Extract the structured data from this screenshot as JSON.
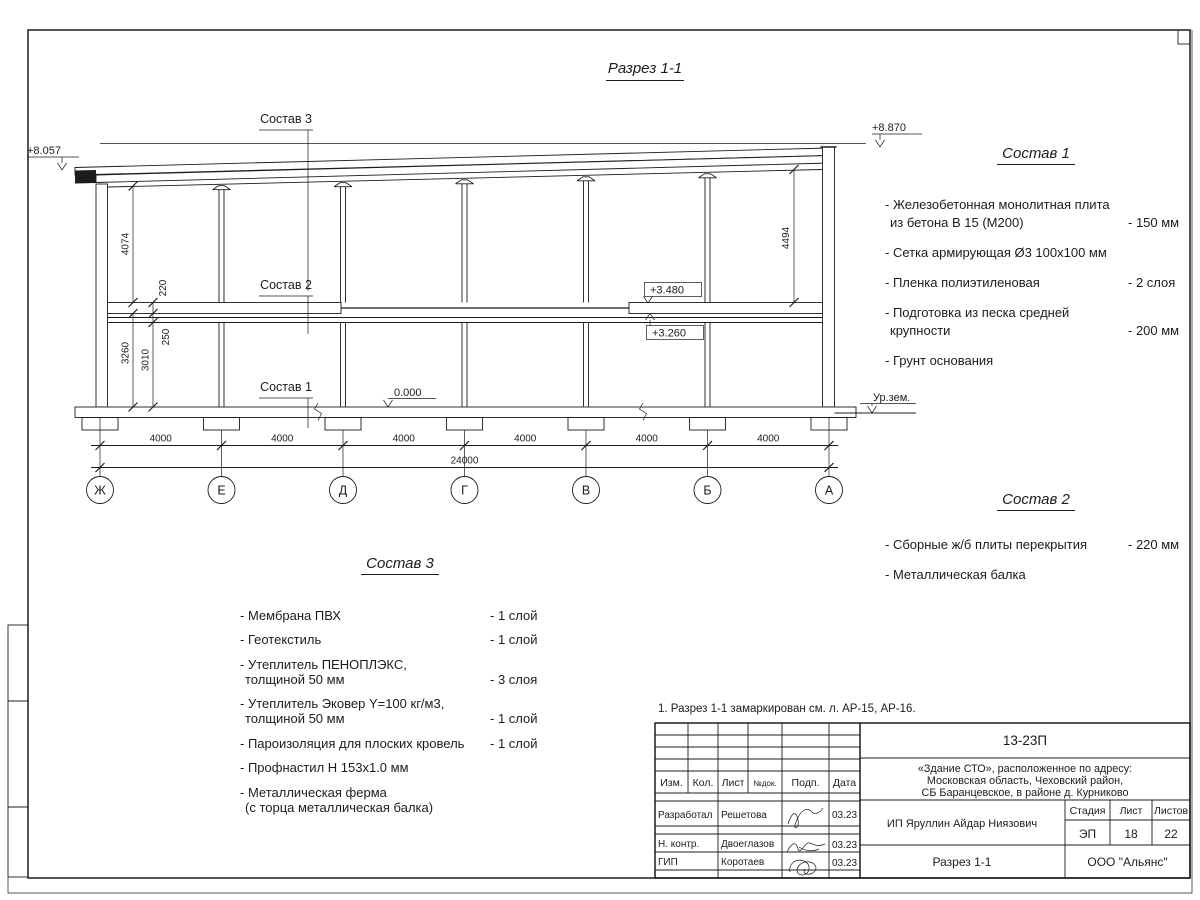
{
  "page": {
    "title": "Разрез 1-1"
  },
  "drawing": {
    "elev_left": "+8.057",
    "elev_right": "+8.870",
    "elev_slab_top": "+3.480",
    "elev_slab_bot": "+3.260",
    "elev_zero": "0.000",
    "ground_label": "Ур.зем.",
    "dim_4074": "4074",
    "dim_220": "220",
    "dim_250": "250",
    "dim_3010": "3010",
    "dim_3260": "3260",
    "dim_4494": "4494",
    "dim_bay": "4000",
    "dim_total": "24000",
    "axes": [
      "Ж",
      "Е",
      "Д",
      "Г",
      "В",
      "Б",
      "А"
    ],
    "label_sostav1": "Состав 1",
    "label_sostav2": "Состав 2",
    "label_sostav3": "Состав 3"
  },
  "sostav1": {
    "title": "Состав 1",
    "items": [
      {
        "line1": "- Железобетонная  монолитная плита",
        "line2": "из бетона В 15 (М200)",
        "value": "- 150 мм"
      },
      {
        "line1": "- Сетка армирующая Ø3 100х100 мм"
      },
      {
        "line1": "- Пленка полиэтиленовая",
        "value": "-  2 слоя"
      },
      {
        "line1": "- Подготовка из песка средней",
        "line2": "крупности",
        "value": "- 200 мм"
      },
      {
        "line1": "- Грунт основания"
      }
    ]
  },
  "sostav2": {
    "title": "Состав 2",
    "items": [
      {
        "line1": "- Сборные ж/б плиты перекрытия",
        "value": "- 220 мм"
      },
      {
        "line1": "- Металлическая  балка"
      }
    ]
  },
  "sostav3": {
    "title": "Состав 3",
    "items": [
      {
        "line1": "- Мембрана ПВХ",
        "value": "- 1 слой"
      },
      {
        "line1": "- Геотекстиль",
        "value": "- 1 слой"
      },
      {
        "line1": "- Утеплитель ПЕНОПЛЭКС,",
        "line2": "толщиной 50 мм",
        "value": "- 3 слоя"
      },
      {
        "line1": "- Утеплитель Эковер Y=100 кг/м3,",
        "line2": "толщиной 50 мм",
        "value": "- 1 слой"
      },
      {
        "line1": "- Пароизоляция для плоских кровель",
        "value": "- 1 слой"
      },
      {
        "line1": "- Профнастил Н 153х1.0 мм"
      },
      {
        "line1": "- Металлическая ферма",
        "line2": "(с торца металлическая балка)"
      }
    ]
  },
  "note": "1. Разрез 1-1 замаркирован см. л. АР-15, АР-16.",
  "titleblock": {
    "doc_number": "13-23П",
    "object_line1": "«Здание СТО», расположенное по адресу:",
    "object_line2": "Московская область, Чеховский район,",
    "object_line3": "СБ Баранцевское, в районе д. Курниково",
    "client": "ИП Яруллин Айдар Ниязович",
    "sheet_title": "Разрез 1-1",
    "company": "ООО \"Альянс\"",
    "cols": {
      "izm": "Изм.",
      "kol": "Кол.",
      "list": "Лист",
      "ndok": "№док.",
      "podp": "Подп.",
      "data": "Дата"
    },
    "rows": [
      {
        "role": "Разработал",
        "name": "Решетова",
        "date": "03.23"
      },
      {
        "role": "Н. контр.",
        "name": "Двоеглазов",
        "date": "03.23"
      },
      {
        "role": "ГИП",
        "name": "Коротаев",
        "date": "03.23"
      }
    ],
    "stage_label": "Стадия",
    "sheet_label": "Лист",
    "sheets_label": "Листов",
    "stage": "ЭП",
    "sheet": "18",
    "sheets": "22"
  }
}
